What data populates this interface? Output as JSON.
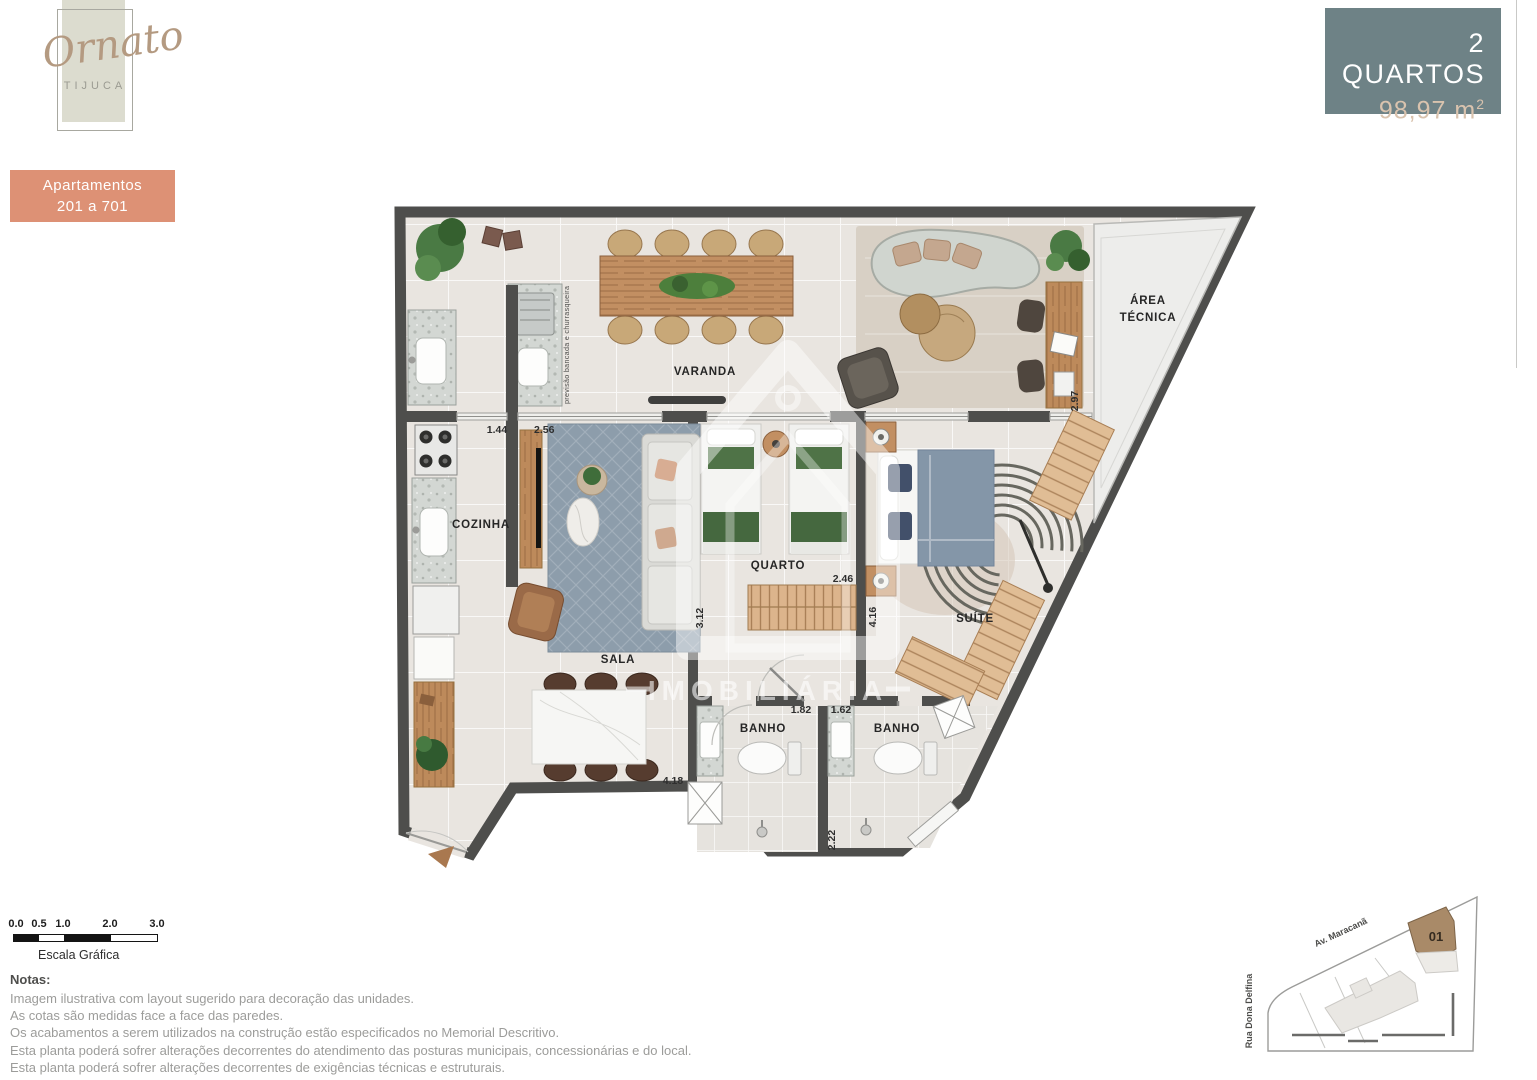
{
  "logo": {
    "name": "Ornato",
    "city": "TIJUCA"
  },
  "apartments_badge": {
    "line1": "Apartamentos",
    "line2": "201 a 701"
  },
  "unit_badge": {
    "bedrooms": "2 QUARTOS",
    "area": "98,97 m",
    "area_exp": "2"
  },
  "floor_plan": {
    "rooms": {
      "varanda": "VARANDA",
      "cozinha": "COZINHA",
      "sala": "SALA",
      "quarto": "QUARTO",
      "suite": "SUÍTE",
      "banho1": "BANHO",
      "banho2": "BANHO",
      "area_tecnica_line1": "ÁREA",
      "area_tecnica_line2": "TÉCNICA"
    },
    "dimensions": [
      "1.44",
      "2.56",
      "2.97",
      "3.12",
      "2.46",
      "4.16",
      "1.82",
      "1.62",
      "4.18",
      "2.22"
    ],
    "annotation_bancada": "previsão bancada e churrasqueira",
    "watermark": "IMOBILIÁRIA"
  },
  "scale_bar": {
    "ticks": [
      "0.0",
      "0.5",
      "1.0",
      "2.0",
      "3.0"
    ],
    "caption": "Escala Gráfica"
  },
  "notes": {
    "title": "Notas:",
    "lines": [
      "Imagem ilustrativa com layout sugerido para decoração das unidades.",
      "As cotas são medidas face a face das paredes.",
      "Os acabamentos a serem utilizados na construção estão especificados no Memorial Descritivo.",
      "Esta planta poderá sofrer alterações decorrentes do atendimento das posturas municipais, concessionárias e do local.",
      "Esta planta poderá sofrer alterações decorrentes de exigências técnicas e estruturais."
    ]
  },
  "site_plan": {
    "street_top": "Av. Maracanã",
    "street_left": "Rua Dona Delfina",
    "unit_number": "01"
  },
  "colors": {
    "accent_salmon": "#dd9175",
    "accent_teal": "#6e8286",
    "accent_beige": "#d9c3ae",
    "wall": "#4e4e4c",
    "wood": "#c28f62",
    "deck": "#e0bd95",
    "rug_blue": "#8d9dab",
    "bed_green": "#4f7347",
    "bed_blue": "#8496a8",
    "site_unit_brown": "#a98a68"
  }
}
